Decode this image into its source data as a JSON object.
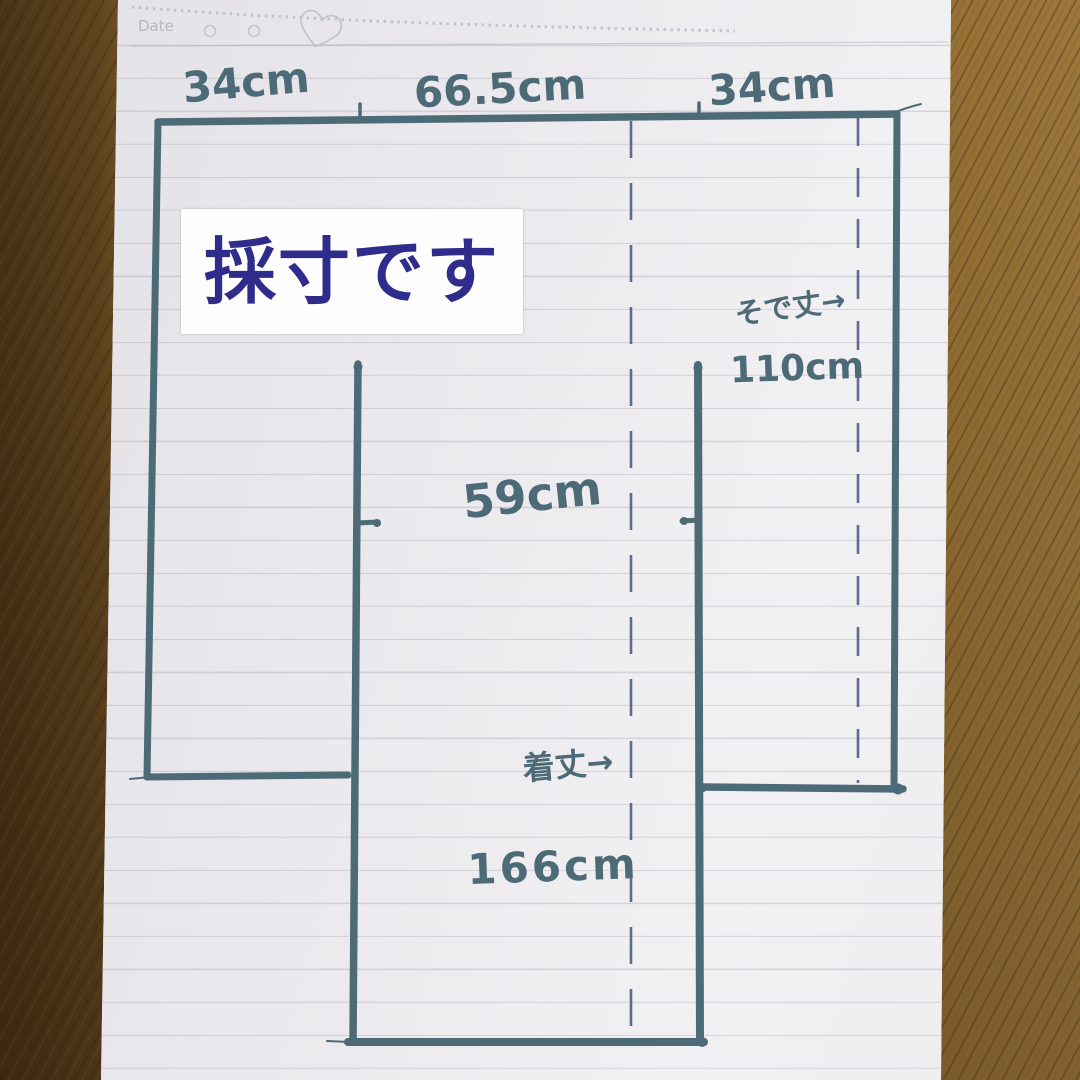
{
  "photo": {
    "description_caption": "採寸です",
    "notebook_header": {
      "date_label": "Date"
    },
    "measurements": {
      "top_left_width": "34cm",
      "top_center_width": "66.5cm",
      "top_right_width": "34cm",
      "body_width": "59cm",
      "sleeve_length_label": "そで丈→",
      "sleeve_length_value": "110cm",
      "garment_length_label": "着丈→",
      "garment_length_value": "166cm"
    },
    "values_cm": {
      "left_sleeve_width": 34,
      "body_panel_width": 66.5,
      "right_sleeve_width": 34,
      "chest_width": 59,
      "sleeve_length": 110,
      "garment_length": 166
    },
    "colors": {
      "marker_ink": "#4d6a77",
      "dashed_pen_ink": "#46527c",
      "caption_text": "#2f2c8c",
      "caption_background": "#fefefe",
      "paper": "#eae9ed",
      "wood_table": "#7b5a27"
    }
  }
}
